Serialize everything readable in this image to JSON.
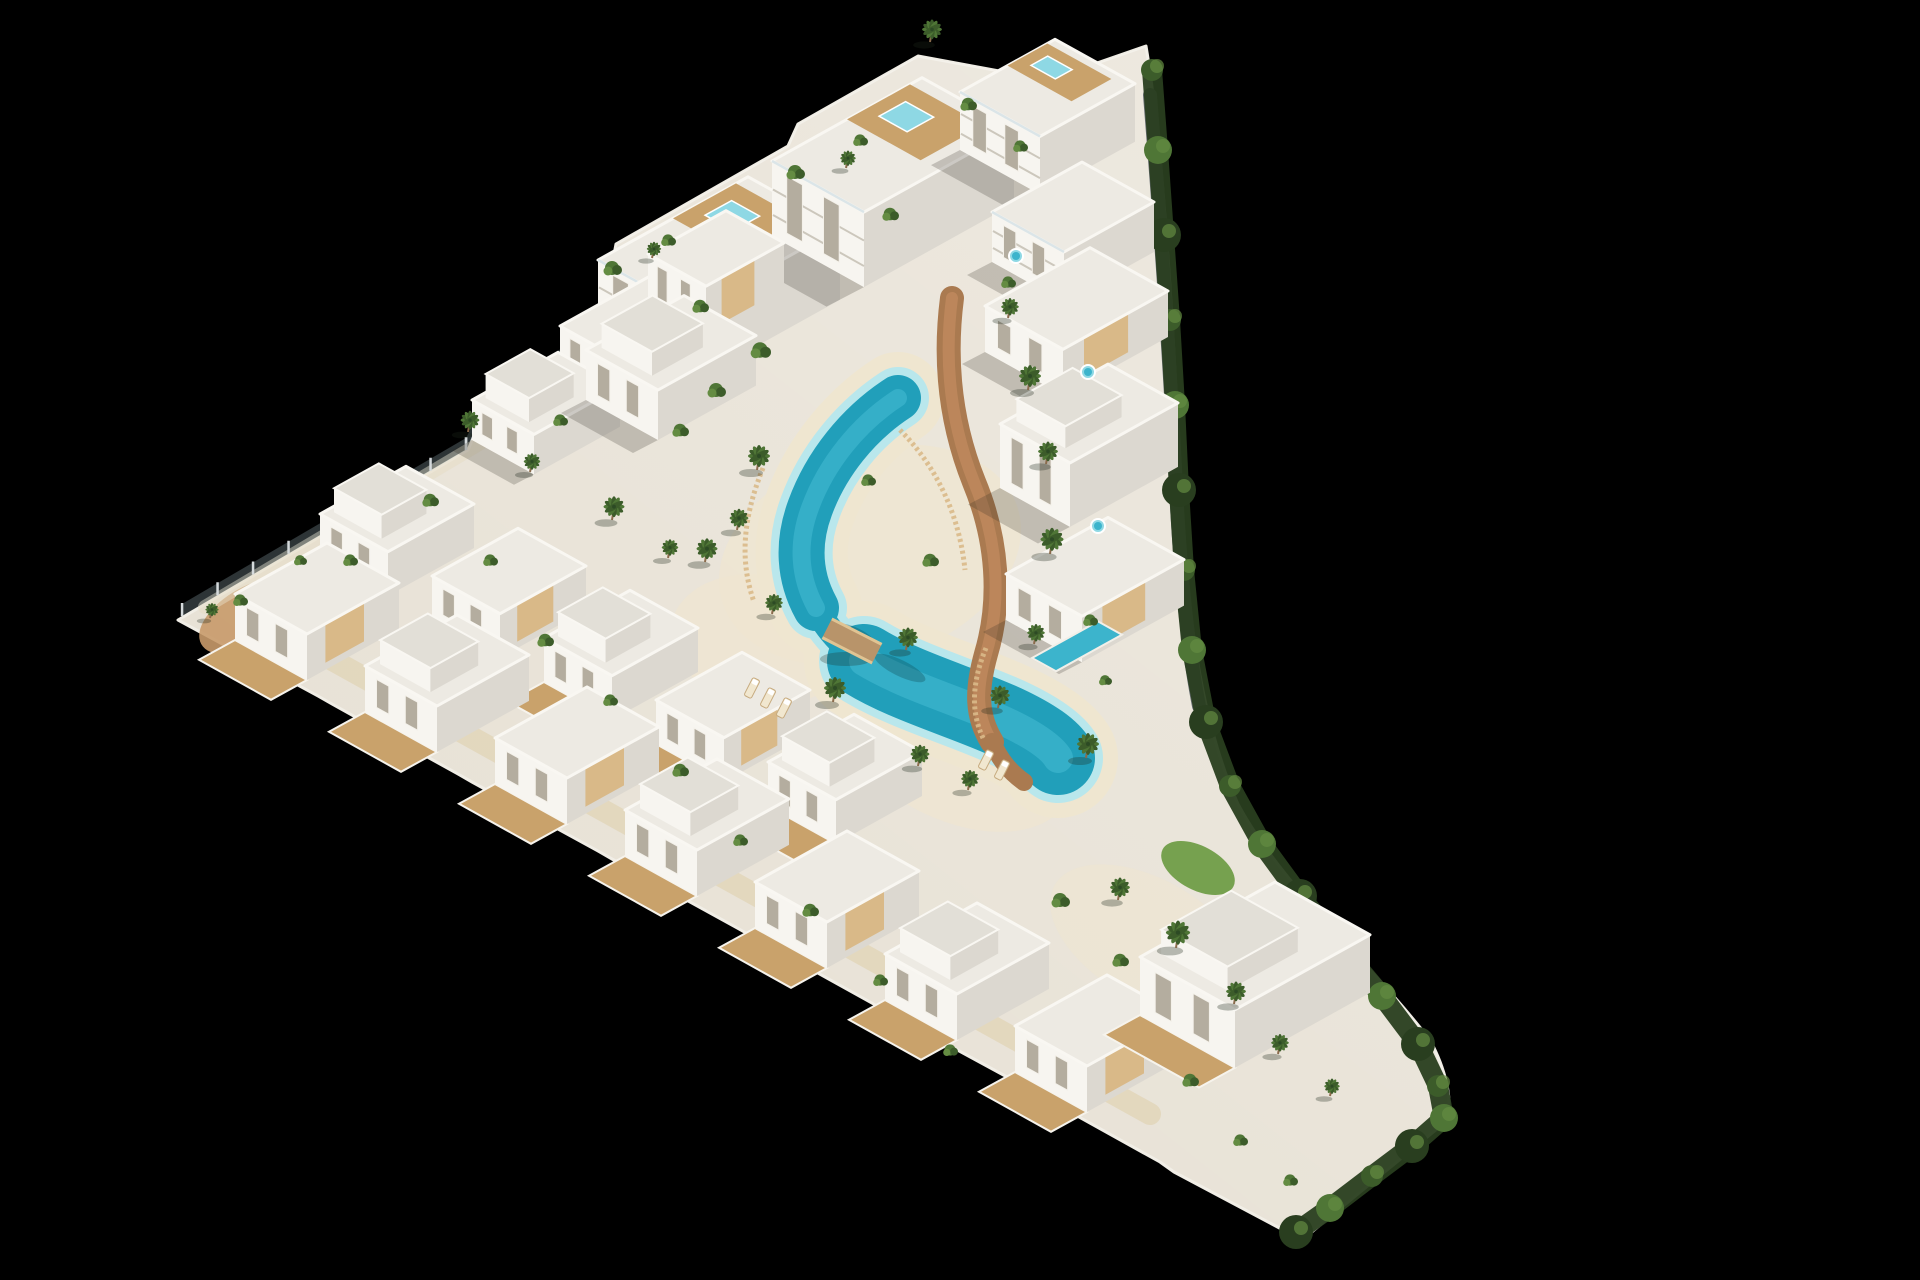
{
  "scene": {
    "type": "aerial-3d-architectural-render",
    "subject": "triangular white residential development with winding lagoon pool, palm trees and perimeter hedge on black background",
    "background_color": "#000000"
  },
  "palette": {
    "bg": "#000000",
    "pave": "#e8e2d6",
    "wallL": "#f7f5f0",
    "wallR": "#dcd8d0",
    "roof": "#edeae3",
    "roofB": "#e2dfd7",
    "wood": "#c9a26b",
    "woodL": "#d9b988",
    "pathBrown": "#aa7a50",
    "sand": "#efe6d0",
    "sandHi": "#f4ecd9",
    "poolDeep": "#219fba",
    "poolMid": "#3cb4cc",
    "poolLight": "#8ed8e4",
    "poolRim": "#b9e7ec",
    "lawn": "#69993f",
    "green1": "#3c5c2a",
    "green2": "#4f7636",
    "green3": "#648c42",
    "hedge": "#293e1f",
    "wallGray": "#636a6e",
    "fence": "#d5dadc",
    "trunk": "#8a6b4c",
    "windowFill": "#b4ad9f",
    "shadow": "rgba(45,40,30,0.22)"
  },
  "site": {
    "outline": "M 178 620 L 468 450 L 488 402 L 598 340 L 616 244 L 788 146 L 798 124 L 918 56 L 1048 80 L 1146 46 C 1162 142 1172 302 1178 434 C 1183 562 1192 702 1238 804 C 1282 886 1368 960 1430 1040 C 1446 1070 1452 1098 1448 1120 L 1302 1240 L 1174 1172 L 1160 1162 L 1034 1092 L 1020 1084 L 893 1015 L 879 1007 L 753 937 L 739 929 L 612 859 L 598 851 L 472 782 L 458 774 L 332 704 L 318 696 Z",
    "tip_terrace": {
      "cx": 252,
      "cy": 616,
      "rx": 58,
      "ry": 30,
      "rot": -29
    },
    "fence_points": [
      [
        182,
        616
      ],
      [
        466,
        450
      ],
      [
        492,
        400
      ],
      [
        612,
        332
      ]
    ],
    "gray_wall": "M 1150 95 C 1160 220 1169 350 1175 468 C 1179 556 1186 640 1199 706",
    "hedge_points": [
      [
        1152,
        70
      ],
      [
        1158,
        150
      ],
      [
        1164,
        235
      ],
      [
        1170,
        320
      ],
      [
        1175,
        405
      ],
      [
        1179,
        490
      ],
      [
        1184,
        570
      ],
      [
        1192,
        650
      ],
      [
        1206,
        722
      ],
      [
        1230,
        786
      ],
      [
        1262,
        844
      ],
      [
        1300,
        896
      ],
      [
        1340,
        946
      ],
      [
        1382,
        996
      ],
      [
        1418,
        1044
      ],
      [
        1438,
        1086
      ],
      [
        1444,
        1118
      ],
      [
        1412,
        1146
      ],
      [
        1372,
        1176
      ],
      [
        1330,
        1208
      ],
      [
        1296,
        1232
      ]
    ],
    "walkways": [
      {
        "d": "M 300 642 L 1150 1114",
        "w": 22,
        "color": "#dcc9a0",
        "op": 0.45
      },
      {
        "d": "M 205 607 L 600 372",
        "w": 14,
        "color": "#e6dcc4",
        "op": 0.5
      }
    ],
    "brown_path": {
      "main": "M 952 298 C 944 360 950 422 974 482 C 998 540 1002 600 986 654 C 976 690 976 716 992 742",
      "spur": "M 992 742 C 1000 760 1010 772 1024 782",
      "center_color": "#c08a5e"
    },
    "slat_fences": [
      "M 763 468 C 742 520 740 562 754 602",
      "M 986 648 C 972 682 970 712 984 740",
      "M 900 430 C 940 470 960 520 965 570"
    ],
    "sand_blobs": [
      {
        "cx": 870,
        "cy": 555,
        "rx": 155,
        "ry": 105,
        "rot": -18,
        "op": 0.75
      },
      {
        "cx": 955,
        "cy": 745,
        "rx": 125,
        "ry": 75,
        "rot": 26,
        "op": 0.75
      },
      {
        "cx": 760,
        "cy": 640,
        "rx": 90,
        "ry": 65,
        "rot": 10,
        "op": 0.7
      },
      {
        "cx": 905,
        "cy": 665,
        "rx": 70,
        "ry": 40,
        "rot": 26,
        "op": 0.8
      },
      {
        "cx": 1150,
        "cy": 940,
        "rx": 110,
        "ry": 60,
        "rot": 30,
        "op": 0.5
      }
    ],
    "lawns": [
      {
        "cx": 1198,
        "cy": 868,
        "rx": 40,
        "ry": 22,
        "rot": 28
      },
      {
        "cx": 1256,
        "cy": 996,
        "rx": 26,
        "ry": 14,
        "rot": 28
      }
    ]
  },
  "lagoon": {
    "segments": [
      {
        "d": "M 898 398 C 858 424 826 464 810 508 C 797 543 799 577 816 608",
        "w": 46
      },
      {
        "d": "M 816 608 C 827 629 842 646 864 661",
        "w": 26
      },
      {
        "d": "M 864 661 C 905 686 962 702 1006 722 C 1036 736 1052 748 1058 758",
        "w": 74
      }
    ],
    "sand_extra": 46,
    "rim_extra": 16,
    "highlights": [
      {
        "seg": 0,
        "w": 18
      },
      {
        "seg": 2,
        "w": 30
      }
    ],
    "palm_shadows": [
      {
        "cx": 900,
        "cy": 668,
        "rx": 28,
        "ry": 8,
        "rot": 26
      },
      {
        "cx": 856,
        "cy": 634,
        "rx": 20,
        "ry": 6,
        "rot": 26
      }
    ],
    "bridge": {
      "cx": 852,
      "cy": 641,
      "w": 56,
      "h": 20,
      "rot": 27
    }
  },
  "buildings": {
    "top": [
      {
        "x": 598,
        "y": 332,
        "u": 150,
        "d": 92,
        "h": 72,
        "floors": true,
        "deckPool": true,
        "name": "apartment-block"
      },
      {
        "x": 772,
        "y": 236,
        "u": 150,
        "d": 92,
        "h": 75,
        "floors": true,
        "deckPool": true,
        "name": "apartment-block"
      },
      {
        "x": 960,
        "y": 150,
        "u": 95,
        "d": 80,
        "h": 58,
        "floors": true,
        "deckPool": true,
        "name": "apartment-block"
      },
      {
        "x": 992,
        "y": 262,
        "u": 90,
        "d": 72,
        "h": 50,
        "floors": true,
        "name": "apartment-block"
      }
    ],
    "right": [
      {
        "x": 985,
        "y": 352,
        "u": 105,
        "d": 78,
        "h": 46,
        "wood": true,
        "name": "villa"
      },
      {
        "x": 1000,
        "y": 488,
        "u": 108,
        "d": 70,
        "h": 64,
        "tower": true,
        "th": 22,
        "name": "villa"
      },
      {
        "x": 1006,
        "y": 620,
        "u": 102,
        "d": 76,
        "h": 46,
        "wood": true,
        "sidePool": {
          "dx": 26,
          "dy": 38,
          "u": 66,
          "d": 24
        },
        "name": "villa"
      }
    ],
    "center": [
      {
        "x": 560,
        "y": 368,
        "u": 88,
        "d": 62,
        "h": 42,
        "name": "villa"
      },
      {
        "x": 648,
        "y": 308,
        "u": 78,
        "d": 58,
        "h": 54,
        "wood": true,
        "name": "villa"
      },
      {
        "x": 472,
        "y": 440,
        "u": 86,
        "d": 62,
        "h": 40,
        "tower": true,
        "name": "villa"
      },
      {
        "x": 586,
        "y": 400,
        "u": 98,
        "d": 72,
        "h": 50,
        "tower": true,
        "name": "villa"
      }
    ],
    "middle": [
      {
        "x": 320,
        "y": 558,
        "u": 86,
        "d": 68,
        "h": 44,
        "terrace": true,
        "tower": true,
        "name": "townhouse"
      },
      {
        "x": 432,
        "y": 620,
        "u": 86,
        "d": 68,
        "h": 44,
        "terrace": true,
        "wood": true,
        "name": "townhouse"
      },
      {
        "x": 544,
        "y": 682,
        "u": 86,
        "d": 68,
        "h": 44,
        "terrace": true,
        "tower": true,
        "name": "townhouse"
      },
      {
        "x": 656,
        "y": 744,
        "u": 86,
        "d": 68,
        "h": 44,
        "terrace": true,
        "wood": true,
        "name": "townhouse"
      },
      {
        "x": 768,
        "y": 806,
        "u": 86,
        "d": 68,
        "h": 44,
        "terrace": true,
        "tower": true,
        "name": "townhouse"
      }
    ],
    "bottom": [
      {
        "x": 235,
        "y": 640,
        "u": 92,
        "d": 72,
        "h": 46,
        "terrace": true,
        "wood": true,
        "name": "townhouse"
      },
      {
        "x": 365,
        "y": 712,
        "u": 92,
        "d": 72,
        "h": 46,
        "terrace": true,
        "tower": true,
        "name": "townhouse"
      },
      {
        "x": 495,
        "y": 784,
        "u": 92,
        "d": 72,
        "h": 46,
        "terrace": true,
        "wood": true,
        "name": "townhouse"
      },
      {
        "x": 625,
        "y": 856,
        "u": 92,
        "d": 72,
        "h": 46,
        "terrace": true,
        "tower": true,
        "name": "townhouse"
      },
      {
        "x": 755,
        "y": 928,
        "u": 92,
        "d": 72,
        "h": 46,
        "terrace": true,
        "wood": true,
        "name": "townhouse"
      },
      {
        "x": 885,
        "y": 1000,
        "u": 92,
        "d": 72,
        "h": 46,
        "terrace": true,
        "tower": true,
        "name": "townhouse"
      },
      {
        "x": 1015,
        "y": 1072,
        "u": 92,
        "d": 72,
        "h": 46,
        "terrace": true,
        "wood": true,
        "name": "townhouse"
      },
      {
        "x": 1140,
        "y": 1015,
        "u": 135,
        "d": 95,
        "h": 58,
        "terrace": true,
        "tower": true,
        "name": "corner-villa"
      }
    ]
  },
  "vegetation": {
    "palms": [
      [
        757,
        470,
        1.0
      ],
      [
        737,
        530,
        0.85
      ],
      [
        705,
        562,
        0.95
      ],
      [
        772,
        614,
        0.8
      ],
      [
        906,
        650,
        0.9
      ],
      [
        833,
        702,
        1.0
      ],
      [
        918,
        766,
        0.85
      ],
      [
        968,
        790,
        0.8
      ],
      [
        1008,
        318,
        0.8
      ],
      [
        1028,
        390,
        1.0
      ],
      [
        1046,
        464,
        0.9
      ],
      [
        1050,
        554,
        1.05
      ],
      [
        1034,
        644,
        0.8
      ],
      [
        998,
        708,
        0.9
      ],
      [
        1086,
        758,
        1.0
      ],
      [
        468,
        432,
        0.85
      ],
      [
        530,
        472,
        0.75
      ],
      [
        612,
        520,
        0.95
      ],
      [
        668,
        558,
        0.75
      ],
      [
        1118,
        900,
        0.9
      ],
      [
        1176,
        948,
        1.1
      ],
      [
        1234,
        1004,
        0.9
      ],
      [
        1278,
        1054,
        0.8
      ],
      [
        1330,
        1096,
        0.7
      ],
      [
        930,
        42,
        0.9
      ],
      [
        846,
        168,
        0.7
      ],
      [
        652,
        258,
        0.65
      ],
      [
        210,
        618,
        0.6
      ]
    ],
    "shrubs": [
      [
        612,
        268,
        1
      ],
      [
        668,
        240,
        0.8
      ],
      [
        700,
        306,
        0.9
      ],
      [
        795,
        172,
        1
      ],
      [
        860,
        140,
        0.8
      ],
      [
        890,
        214,
        0.9
      ],
      [
        968,
        104,
        0.9
      ],
      [
        1020,
        146,
        0.8
      ],
      [
        1008,
        282,
        0.8
      ],
      [
        760,
        350,
        1.1
      ],
      [
        716,
        390,
        1
      ],
      [
        680,
        430,
        0.9
      ],
      [
        560,
        420,
        0.8
      ],
      [
        430,
        500,
        0.9
      ],
      [
        350,
        560,
        0.8
      ],
      [
        300,
        560,
        0.7
      ],
      [
        490,
        560,
        0.8
      ],
      [
        545,
        640,
        0.9
      ],
      [
        610,
        700,
        0.8
      ],
      [
        680,
        770,
        0.9
      ],
      [
        740,
        840,
        0.8
      ],
      [
        810,
        910,
        0.9
      ],
      [
        880,
        980,
        0.8
      ],
      [
        950,
        1050,
        0.8
      ],
      [
        1060,
        900,
        1
      ],
      [
        1120,
        960,
        0.9
      ],
      [
        1190,
        1080,
        0.9
      ],
      [
        1240,
        1140,
        0.8
      ],
      [
        1290,
        1180,
        0.8
      ],
      [
        1090,
        620,
        0.8
      ],
      [
        1105,
        680,
        0.7
      ],
      [
        930,
        560,
        0.9
      ],
      [
        868,
        480,
        0.8
      ],
      [
        240,
        600,
        0.8
      ]
    ]
  },
  "amenities": {
    "loungers": [
      [
        752,
        688,
        27
      ],
      [
        768,
        698,
        27
      ],
      [
        784,
        708,
        27
      ],
      [
        986,
        760,
        27
      ],
      [
        1002,
        770,
        27
      ]
    ],
    "jacuzzis": [
      [
        1088,
        372
      ],
      [
        1098,
        526
      ],
      [
        1016,
        256
      ]
    ]
  }
}
